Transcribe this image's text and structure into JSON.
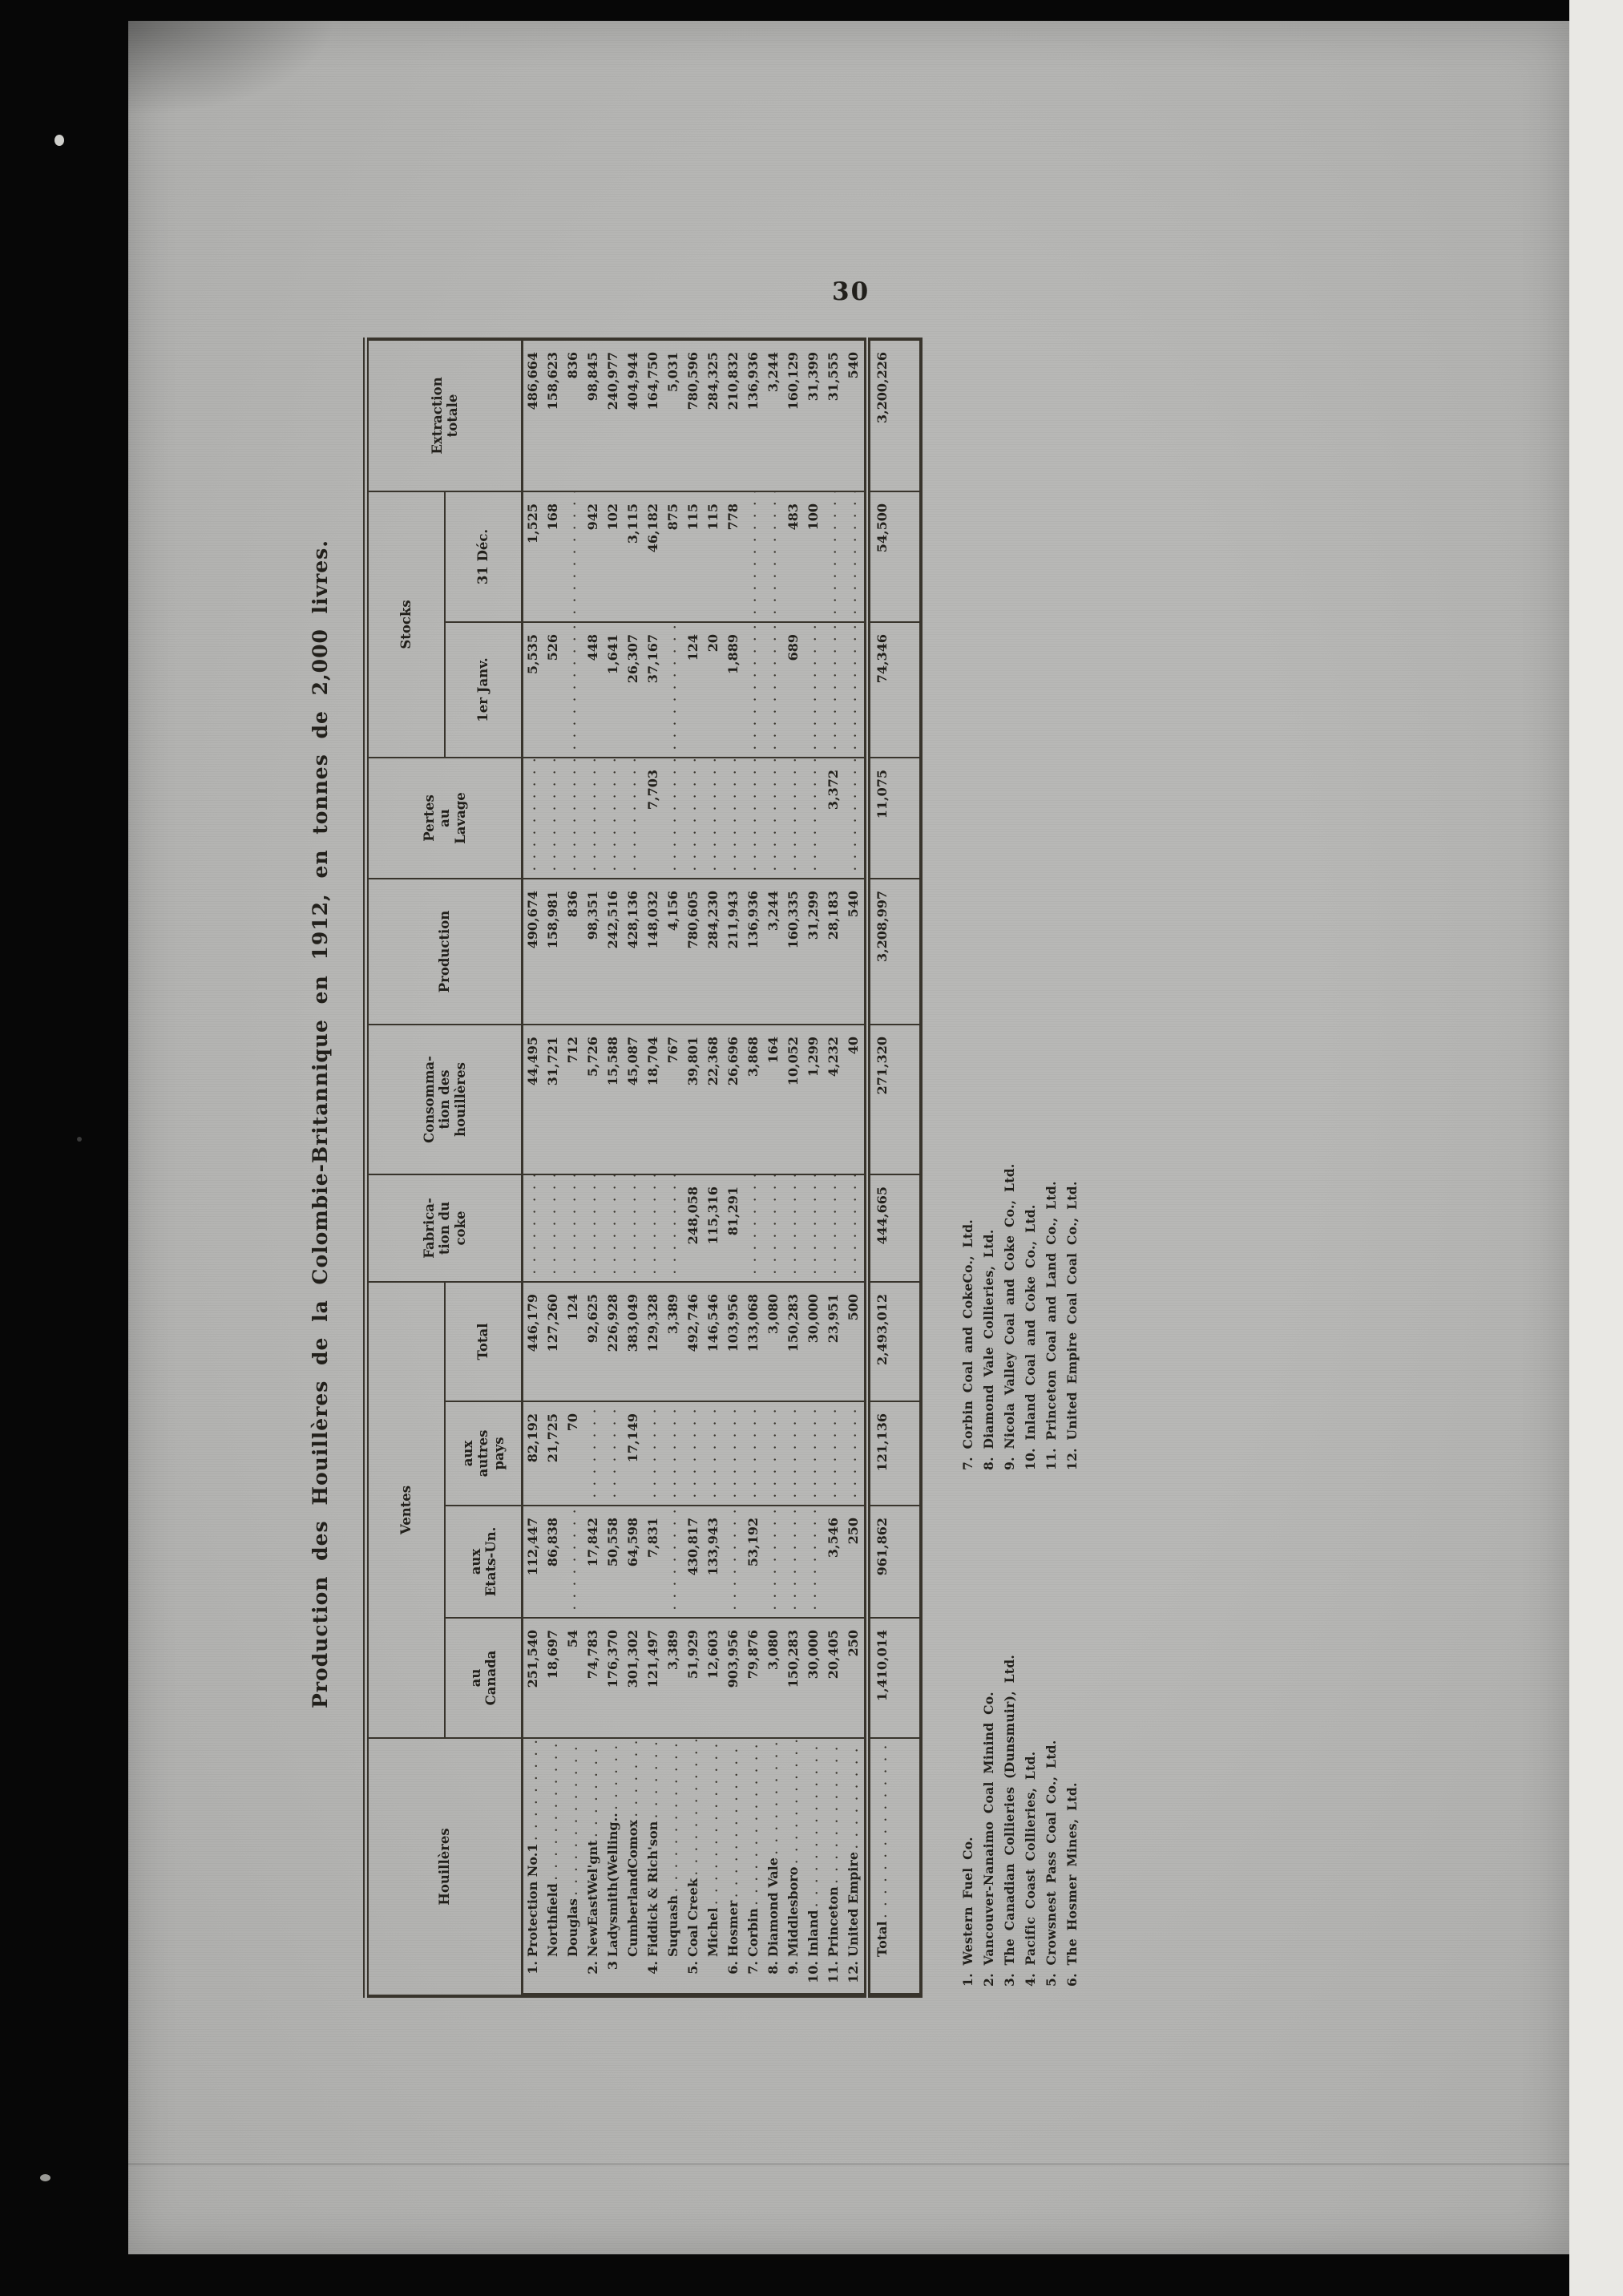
{
  "page": {
    "number": "30"
  },
  "title": "Production des Houillères de la Colombie-Britannique en 1912, en tonnes de 2,000 livres.",
  "table": {
    "headers": {
      "houilleres": "Houillères",
      "ventes": "Ventes",
      "canada": "au\nCanada",
      "eu": "aux\nEtats-Un.",
      "autres": "aux\nautres\npays",
      "total": "Total",
      "coke": "Fabrica-\ntion du\ncoke",
      "conso": "Consomma-\ntion des\nhouillères",
      "prod": "Production",
      "pertes": "Pertes\nau\nLavage",
      "stocks": "Stocks",
      "janv": "1er Janv.",
      "dec": "31 Déc.",
      "extr": "Extraction\ntotale"
    },
    "rows": [
      {
        "num": "1.",
        "name": "Protection No.1",
        "canada": "251,540",
        "eu": "112,447",
        "autres": "82,192",
        "total": "446,179",
        "coke": "",
        "conso": "44,495",
        "prod": "490,674",
        "pertes": "",
        "janv": "5,535",
        "dec": "1,525",
        "extr": "486,664"
      },
      {
        "num": "",
        "name": "Northfield",
        "canada": "18,697",
        "eu": "86,838",
        "autres": "21,725",
        "total": "127,260",
        "coke": "",
        "conso": "31,721",
        "prod": "158,981",
        "pertes": "",
        "janv": "526",
        "dec": "168",
        "extr": "158,623"
      },
      {
        "num": "",
        "name": "Douglas",
        "canada": "54",
        "eu": "",
        "autres": "70",
        "total": "124",
        "coke": "",
        "conso": "712",
        "prod": "836",
        "pertes": "",
        "janv": "",
        "dec": "",
        "extr": "836"
      },
      {
        "num": "2.",
        "name": "NewEastWel'gnt",
        "canada": "74,783",
        "eu": "17,842",
        "autres": "",
        "total": "92,625",
        "coke": "",
        "conso": "5,726",
        "prod": "98,351",
        "pertes": "",
        "janv": "448",
        "dec": "942",
        "extr": "98,845"
      },
      {
        "num": "3",
        "name": "Ladysmith(Welling..",
        "canada": "176,370",
        "eu": "50,558",
        "autres": "",
        "total": "226,928",
        "coke": "",
        "conso": "15,588",
        "prod": "242,516",
        "pertes": "",
        "janv": "1,641",
        "dec": "102",
        "extr": "240,977"
      },
      {
        "num": "",
        "name": "CumberlandComox",
        "canada": "301,302",
        "eu": "64,598",
        "autres": "17,149",
        "total": "383,049",
        "coke": "",
        "conso": "45,087",
        "prod": "428,136",
        "pertes": "",
        "janv": "26,307",
        "dec": "3,115",
        "extr": "404,944"
      },
      {
        "num": "4.",
        "name": "Fiddick & Rich'son",
        "canada": "121,497",
        "eu": "7,831",
        "autres": "",
        "total": "129,328",
        "coke": "",
        "conso": "18,704",
        "prod": "148,032",
        "pertes": "7,703",
        "janv": "37,167",
        "dec": "46,182",
        "extr": "164,750"
      },
      {
        "num": "",
        "name": "Suquash",
        "canada": "3,389",
        "eu": "",
        "autres": "",
        "total": "3,389",
        "coke": "",
        "conso": "767",
        "prod": "4,156",
        "pertes": "",
        "janv": "",
        "dec": "875",
        "extr": "5,031"
      },
      {
        "num": "5.",
        "name": "Coal Creek",
        "canada": "51,929",
        "eu": "430,817",
        "autres": "",
        "total": "492,746",
        "coke": "248,058",
        "conso": "39,801",
        "prod": "780,605",
        "pertes": "",
        "janv": "124",
        "dec": "115",
        "extr": "780,596"
      },
      {
        "num": "",
        "name": "Michel",
        "canada": "12,603",
        "eu": "133,943",
        "autres": "",
        "total": "146,546",
        "coke": "115,316",
        "conso": "22,368",
        "prod": "284,230",
        "pertes": "",
        "janv": "20",
        "dec": "115",
        "extr": "284,325"
      },
      {
        "num": "6.",
        "name": "Hosmer",
        "canada": "903,956",
        "eu": "",
        "autres": "",
        "total": "103,956",
        "coke": "81,291",
        "conso": "26,696",
        "prod": "211,943",
        "pertes": "",
        "janv": "1,889",
        "dec": "778",
        "extr": "210,832"
      },
      {
        "num": "7.",
        "name": "Corbin",
        "canada": "79,876",
        "eu": "53,192",
        "autres": "",
        "total": "133,068",
        "coke": "",
        "conso": "3,868",
        "prod": "136,936",
        "pertes": "",
        "janv": "",
        "dec": "",
        "extr": "136,936"
      },
      {
        "num": "8.",
        "name": "Diamond Vale",
        "canada": "3,080",
        "eu": "",
        "autres": "",
        "total": "3,080",
        "coke": "",
        "conso": "164",
        "prod": "3,244",
        "pertes": "",
        "janv": "",
        "dec": "",
        "extr": "3,244"
      },
      {
        "num": "9.",
        "name": "Middlesboro",
        "canada": "150,283",
        "eu": "",
        "autres": "",
        "total": "150,283",
        "coke": "",
        "conso": "10,052",
        "prod": "160,335",
        "pertes": "",
        "janv": "689",
        "dec": "483",
        "extr": "160,129"
      },
      {
        "num": "10.",
        "name": "Inland",
        "canada": "30,000",
        "eu": "",
        "autres": "",
        "total": "30,000",
        "coke": "",
        "conso": "1,299",
        "prod": "31,299",
        "pertes": "",
        "janv": "",
        "dec": "100",
        "extr": "31,399"
      },
      {
        "num": "11.",
        "name": "Princeton",
        "canada": "20,405",
        "eu": "3,546",
        "autres": "",
        "total": "23,951",
        "coke": "",
        "conso": "4,232",
        "prod": "28,183",
        "pertes": "3,372",
        "janv": "",
        "dec": "",
        "extr": "31,555"
      },
      {
        "num": "12.",
        "name": "United Empire",
        "canada": "250",
        "eu": "250",
        "autres": "",
        "total": "500",
        "coke": "",
        "conso": "40",
        "prod": "540",
        "pertes": "",
        "janv": "",
        "dec": "",
        "extr": "540"
      }
    ],
    "total_row": {
      "label": "Total",
      "canada": "1,410,014",
      "eu": "961,862",
      "autres": "121,136",
      "total": "2,493,012",
      "coke": "444,665",
      "conso": "271,320",
      "prod": "3,208,997",
      "pertes": "11,075",
      "janv": "74,346",
      "dec": "54,500",
      "extr": "3,200,226"
    }
  },
  "footnotes": {
    "col1": [
      "1. Western Fuel Co.",
      "2. Vancouver-Nanaimo Coal Minind Co.",
      "3. The Canadian Collieries (Dunsmuir), Ltd.",
      "4. Pacific Coast Collieries, Ltd.",
      "5. Crowsnest Pass Coal Co., Ltd.",
      "6. The Hosmer Mines, Ltd."
    ],
    "col2": [
      "7. Corbin Coal and CokeCo., Ltd.",
      "8. Diamond Vale Collieries, Ltd.",
      "9. Nicola Valley Coal and Coke Co., Ltd.",
      "10. Inland Coal and Coke Co., Ltd.",
      "11. Princeton Coal and Land Co., Ltd.",
      "12. United Empire Coal Coal Co., Ltd."
    ]
  }
}
